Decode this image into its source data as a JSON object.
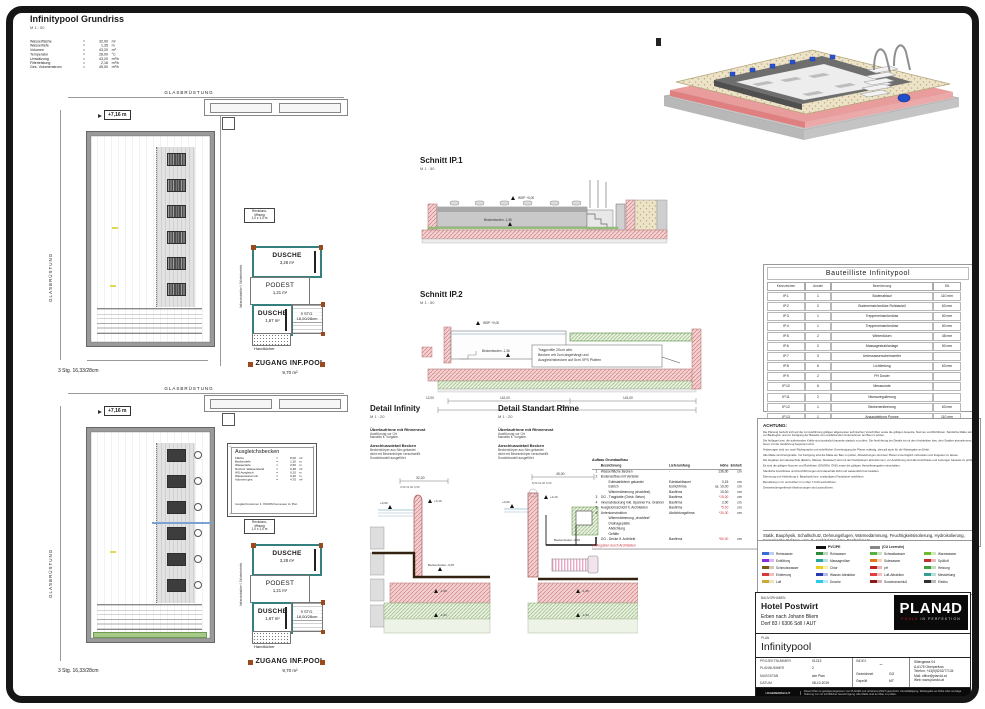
{
  "grundriss": {
    "title": "Infinitypool Grundriss",
    "scale": "M 1 : 50",
    "specs": [
      {
        "label": "Wasserfläche",
        "value": "32,00",
        "unit": "m²"
      },
      {
        "label": "Wassertiefe",
        "value": "1,35",
        "unit": "m"
      },
      {
        "label": "Volumen",
        "value": "43,20",
        "unit": "m³"
      },
      {
        "label": "Temperatur",
        "value": "28,00",
        "unit": "°C"
      },
      {
        "label": "Umwälzung",
        "value": "43,20",
        "unit": "m³/h"
      },
      {
        "label": "Filterleistung",
        "value": "2,16",
        "unit": "m³/h"
      },
      {
        "label": "Ges. Volumenstrom",
        "value": "45,00",
        "unit": "m³/h"
      }
    ]
  },
  "plan": {
    "glasbruestung": "GLASBRÜSTUNG",
    "level": "+7,16 m",
    "revisions": [
      "Revisions-",
      "öffnung",
      "1,0 x 1,0 m"
    ],
    "dusche1": {
      "name": "DUSCHE",
      "area": "3,28 m²"
    },
    "podest": {
      "name": "PODEST",
      "area": "1,21 m²"
    },
    "dusche2": {
      "name": "DUSCHE",
      "area": "1,67 m²"
    },
    "stairs9": [
      "9 STG.",
      "18,00/28cm"
    ],
    "handtuecher": "Handtücher",
    "zugang": {
      "name": "ZUGANG INF.POOL",
      "area": "9,70 m²"
    },
    "stairs3": "3 Stg. 16,33/28cm",
    "infrarot": "Infrarotstrahler f. Winterbetrieb"
  },
  "ausgleichsbecken": {
    "title": "Ausgleichsbecken",
    "rows": [
      {
        "label": "Fläche",
        "value": "8,00",
        "unit": "m²"
      },
      {
        "label": "Beckentiefe",
        "value": "1,20",
        "unit": "m"
      },
      {
        "label": "Wassertiefe",
        "value": "0,60",
        "unit": "m"
      },
      {
        "label": "Nutzvol. Wasserstand",
        "value": "0,48",
        "unit": "m³"
      },
      {
        "label": "WS Ausgleich",
        "value": "0,15",
        "unit": "m"
      },
      {
        "label": "Wasserstand min.",
        "value": "0,30",
        "unit": "m"
      },
      {
        "label": "Volumen ges.",
        "value": "4,75",
        "unit": "m³"
      }
    ],
    "footnote": "Ausgleichsvolumen lt. ÖNORM bemessen im Plan"
  },
  "schnitt1": {
    "title": "Schnitt IP.1",
    "scale": "M 1 : 50",
    "labels": {
      "wsp": "WSP +0,00",
      "boden": "Beckenboden -1,36"
    }
  },
  "schnitt2": {
    "title": "Schnitt IP.2",
    "scale": "M 1 : 50",
    "annotation": [
      "Tragprofile 20cm abh.",
      "Becken mit 2cm abgehängt und",
      "Ausgleichsbecken auf 5cm XPS Platten"
    ],
    "labels": {
      "wsp": "WSP +0,00",
      "boden": "Beckenboden -1,36",
      "dim1": "142,00",
      "dim2": "143,00",
      "dim3": "285,00",
      "dim4": "12,00"
    }
  },
  "detail_infinity": {
    "title": "Detail Infinity",
    "scale": "M 1 : 20",
    "note1_head": "Überlaufrinne mit Rinnenrost",
    "note1_lines": [
      "Ausführung vor Ort",
      "bauseits lt. Vorgabe"
    ],
    "note2_head": "Anschlussdetail Becken",
    "note2_lines": [
      "Beckenkörper aus Niro gekantet",
      "dicht mit Beckenkörper verschweißt",
      "Sonderbauteil ausgeführt"
    ],
    "dims": {
      "top": "32,00",
      "sub": "4,50  21,00  6,50",
      "wsp": "+0,00",
      "niveau": "+0,10",
      "boden": "Beckenboden -0,05",
      "l1": "-1,05",
      "l2": "-1,60"
    }
  },
  "detail_rinne": {
    "title": "Detail Standart Rinne",
    "scale": "M 1 : 20",
    "note1_head": "Überlaufrinne mit Rinnenrost",
    "note1_lines": [
      "Ausführung vor Ort",
      "bauseits lt. Vorgabe"
    ],
    "note2_head": "Anschlussdetail Becken",
    "note2_lines": [
      "Beckenkörper aus Niro gekantet",
      "dicht mit Beckenkörper verschweißt",
      "Sonderbauteil ausgeführt"
    ],
    "dims": {
      "top": "45,00",
      "sub": "8,00  21,00  6,00",
      "wsp": "+0,00",
      "niveau": "+0,10",
      "boden": "Beckenboden -0,05",
      "l1": "-1,05",
      "l2": "-1,60"
    }
  },
  "aufbau": {
    "title": "Aufbau Grundaufbau",
    "headers": [
      "Bezeichnung",
      "Lieferumfang",
      "Höhe",
      "Einheit"
    ],
    "rows": [
      {
        "num": "1",
        "name": "Wasserfläche Becken",
        "lief": "-",
        "hoehe": "136,00",
        "unit": "cm",
        "red": false,
        "indent": 0
      },
      {
        "num": "2",
        "name": "Bodenaufbau mit Verteiler",
        "lief": "",
        "hoehe": "",
        "unit": "",
        "red": false,
        "indent": 0
      },
      {
        "num": "",
        "name": "Edelstahlblech gekantet",
        "lief": "Edelstahlbauer",
        "hoehe": "0,15",
        "unit": "cm",
        "red": false,
        "indent": 1
      },
      {
        "num": "",
        "name": "Estrich",
        "lief": "Estrichfirma",
        "hoehe": "ca. 10,00",
        "unit": "cm",
        "red": false,
        "indent": 1
      },
      {
        "num": "",
        "name": "Wärmedämmung (druckfest)",
        "lief": "Baufirma",
        "hoehe": "10,00",
        "unit": "cm",
        "red": false,
        "indent": 1
      },
      {
        "num": "3",
        "name": "OG - Tragplatte (Ortsb. Beton)",
        "lief": "Baufirma",
        "hoehe": "*15,00",
        "unit": "cm",
        "red": true,
        "indent": 0
      },
      {
        "num": "4",
        "name": "Innenabdeckung inkl. Spanner Fa. Grabner",
        "lief": "Baufirma",
        "hoehe": "2,00",
        "unit": "cm",
        "red": false,
        "indent": 0
      },
      {
        "num": "5",
        "name": "Ausgleichsschicht lt. Architekten",
        "lief": "Baufirma",
        "hoehe": "*5,00",
        "unit": "cm",
        "red": true,
        "indent": 0
      },
      {
        "num": "6",
        "name": "Unterkonstruktion",
        "lief": "Abdichtungsfirma",
        "hoehe": "*30,00",
        "unit": "cm",
        "red": true,
        "indent": 0
      },
      {
        "num": "",
        "name": "Wärmedämmung „druckfest“",
        "lief": "",
        "hoehe": "",
        "unit": "",
        "red": false,
        "indent": 1
      },
      {
        "num": "",
        "name": "Drainageplatte",
        "lief": "",
        "hoehe": "",
        "unit": "",
        "red": false,
        "indent": 1
      },
      {
        "num": "",
        "name": "Abdichtung",
        "lief": "",
        "hoehe": "",
        "unit": "",
        "red": false,
        "indent": 1
      },
      {
        "num": "",
        "name": "Gefälle",
        "lief": "",
        "hoehe": "",
        "unit": "",
        "red": false,
        "indent": 1
      },
      {
        "num": "7",
        "name": "OG - Decke lt. Architekt",
        "lief": "Baufirma",
        "hoehe": "*80,00",
        "unit": "cm",
        "red": true,
        "indent": 0
      }
    ],
    "footnote": "(*) Angaben durch Architekten"
  },
  "bauteilliste": {
    "title": "Bauteilliste Infinitypool",
    "headers": [
      "Kennzeichen",
      "Anzahl",
      "Bezeichnung",
      "DN"
    ],
    "rows": [
      [
        "IP.1",
        "1",
        "Bodenablauf",
        "110 mm"
      ],
      [
        "IP.2",
        "2",
        "Bodeneinströmdüse Rohbauteil",
        "63 mm"
      ],
      [
        "IP.3",
        "1",
        "Treppeneinströmdüse",
        "50 mm"
      ],
      [
        "IP.4",
        "1",
        "Treppeneinströmdüse",
        "50 mm"
      ],
      [
        "IP.5",
        "2",
        "Winterdüsen",
        "48 mm"
      ],
      [
        "IP.6",
        "2",
        "Massagestrahlanlage",
        "50 mm"
      ],
      [
        "IP.7",
        "3",
        "Unterwasserscheinwerfer",
        ""
      ],
      [
        "IP.8",
        "6",
        "Lichtleitung",
        "63 mm"
      ],
      [
        "IP.9",
        "2",
        "PH Dosier",
        ""
      ],
      [
        "IP.10",
        "6",
        "Messsonde",
        ""
      ],
      [
        "IP.11",
        "2",
        "Niveauregulierung",
        ""
      ],
      [
        "IP.12",
        "1",
        "Beckenentleerung",
        "63 mm"
      ],
      [
        "IP.13",
        "1",
        "Ansaugleitung Pumpe",
        "110 mm"
      ]
    ]
  },
  "achtung": {
    "title": "ACHTUNG:",
    "paragraphs": [
      "Die Planung bezieht sich auf die zur Ausführung gültigen allgemeinen technischen Vorschriften sowie die gültigen Gesetze, Normen und Richtlinien. Sämtliche Maße sind vor Baubeginn und vor Fertigung der Bauteile vom ausführenden Unternehmen am Bau zu prüfen.",
      "Die Auflagen bzw. die auftretenden Kräfte sind zusätzlich bauseits statisch zu prüfen. Die Ausführung der Details ist mit dem Architekten bzw. dem Statiker abzustimmen, bevor mit der Ausführung begonnen wird.",
      "Änderungen sind nur nach Rücksprache und schriftlicher Genehmigung der Planer zulässig, dies gilt auch für die Weitergabe an Dritte.",
      "Alle Maße sind Fertigmaße. Vor Fertigung sind die Maße am Bau zu prüfen, Abweichungen sind dem Planer unverzüglich mitzuteilen und freigeben zu lassen.",
      "Die Angaben der Haustechnik (Elektro, Wasser, Abwasser) sind mit den Fachplanern abzustimmen, vor Ausführung sind alle Anschlüsse und Leitungen bauseits zu prüfen.",
      "Es sind die gültigen Normen und Richtlinien (ÖNORM, ÖVE) sowie die gültigen Herstellerangaben einzuhalten.",
      "Sämtliche Anschlüsse und Durchführungen sind dauerhaft dicht und wasserdicht herzustellen.",
      "Dämmung und Abdichtung lt. Bauphysik bzw. zuständigem Fachplaner ausführen.",
      "Bemaßung in cm und Höhen in m über ± 0,00 auszuführen.",
      "Gewerkeübergreifende Abstimmungen sind auszuführen."
    ],
    "footer": "Statik, Bauphysik, Schallschutz, Dehnungsfugen, Wärmedämmung, Feuchtigkeitsisolierung, Hydroisolierung, Keramische Beläge: usw. lt. Architekten bzw. Fachplanern"
  },
  "legend": {
    "columns": [
      {
        "header": null,
        "items": [
          {
            "color": "#3a6bd6",
            "label": "Reinwasser"
          },
          {
            "color": "#8a2be2",
            "label": "Entlüftung"
          },
          {
            "color": "#7a5a1a",
            "label": "Schmutzwasser"
          },
          {
            "color": "#d43a3a",
            "label": "Entleerung"
          },
          {
            "color": "#caa83a",
            "label": "Luft"
          }
        ]
      },
      {
        "header": {
          "label": "PVC/PE",
          "swatch": "#111111"
        },
        "items": [
          {
            "color": "#2e8b3a",
            "label": "Rohwasser"
          },
          {
            "color": "#2aa8a0",
            "label": "Massagedüse"
          },
          {
            "color": "#e8d020",
            "label": "Chlor"
          },
          {
            "color": "#2a3ab0",
            "label": "Wasser-Attraktion"
          },
          {
            "color": "#30c8e8",
            "label": "Dusche"
          }
        ]
      },
      {
        "header": {
          "label": "(CU Leerrohr)",
          "swatch": "#888888"
        },
        "items": [
          {
            "color": "#58b040",
            "label": "Schwallwasser"
          },
          {
            "color": "#e07820",
            "label": "Solewasser"
          },
          {
            "color": "#c02020",
            "label": "pH"
          },
          {
            "color": "#e04040",
            "label": "Luft-Attraktion"
          },
          {
            "color": "#8a1a1a",
            "label": "Sonderanschluß"
          }
        ]
      },
      {
        "header": null,
        "items": [
          {
            "color": "#70b830",
            "label": "Warmwasser"
          },
          {
            "color": "#c03030",
            "label": "Spülluft"
          },
          {
            "color": "#40a040",
            "label": "Heizung"
          },
          {
            "color": "#30a090",
            "label": "Messleitung"
          },
          {
            "color": "#303030",
            "label": "Elektro"
          }
        ]
      }
    ]
  },
  "titleblock": {
    "bauvorhaben_label": "BAUVORHABEN",
    "client": "Hotel Postwirt",
    "line2": "Erben nach Johann Bliem",
    "line3": "Dorf 83 / 6306 Söll / AUT",
    "plan_label": "PLAN",
    "plan_name": "Infinitypool",
    "logo_text": "PLAN4D",
    "logo_sub_red": "POOLS",
    "logo_sub_rest": " IN PERFEKTION",
    "fields": [
      {
        "label": "PROJEKTNUMMER",
        "value": "01213"
      },
      {
        "label": "PLANNUMMER",
        "value": "2"
      },
      {
        "label": "MASSSTAB",
        "value": "wie Plan"
      },
      {
        "label": "DATUM",
        "value": "08-10.2019"
      }
    ],
    "index_label": "INDEX",
    "index_value": "–",
    "gezeichnet_label": "Gezeichnet",
    "gezeichnet": "GG",
    "geprueft_label": "Geprüft",
    "geprueft": "MT",
    "address": [
      "Sittergasse 04",
      "A-6175 Oberperfuss",
      "Telefon: +43(0)5232/77134",
      "Mail: office@plan4d.at",
      "Web: www.plan4d.at"
    ],
    "footer_left": "URHEBERRECHT",
    "footer_text": "Dieser Plan ist geistiges Eigentum von PLAN4D und urheberrechtlich geschützt. Vervielfältigung, Weitergabe an Dritte oder sonstige Nutzung nur mit schriftlicher Genehmigung. Alle Maße sind am Bau zu prüfen."
  }
}
